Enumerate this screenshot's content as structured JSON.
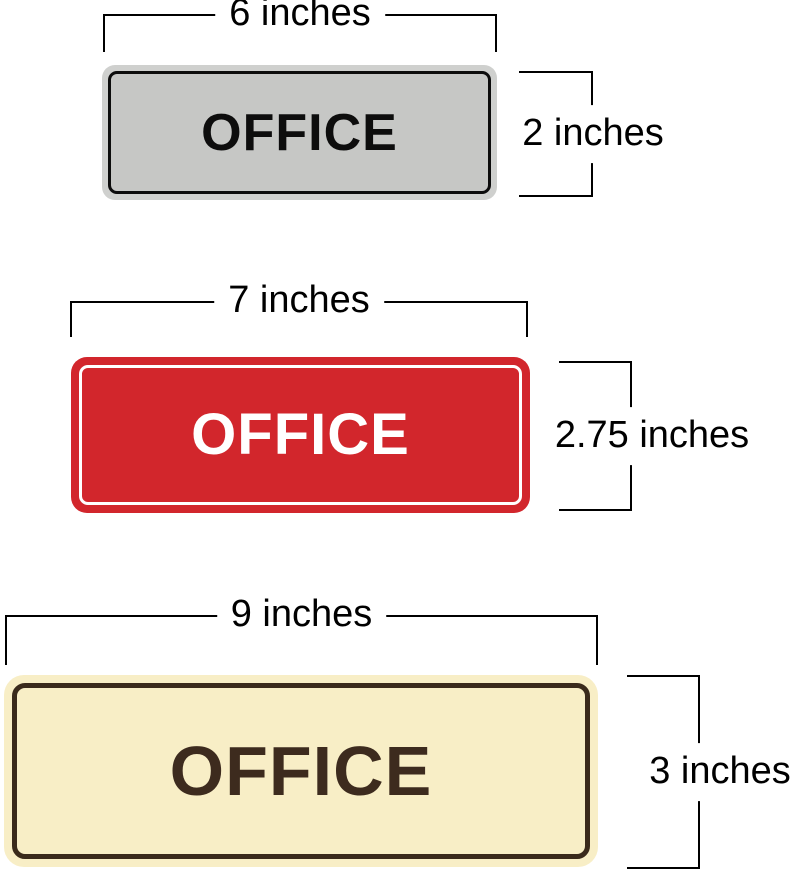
{
  "page": {
    "background": "#ffffff",
    "dimension_line_color": "#000000",
    "dimension_label_color": "#000000"
  },
  "signs": [
    {
      "label": "OFFICE",
      "width_label": "6 inches",
      "height_label": "2 inches",
      "fill": "#c6c7c5",
      "frame": "#cfd0ce",
      "border": "#0c0c0c",
      "text_color": "#0d0d0d"
    },
    {
      "label": "OFFICE",
      "width_label": "7 inches",
      "height_label": "2.75 inches",
      "fill": "#d2262c",
      "stroke": "#ffffff",
      "text_color": "#ffffff"
    },
    {
      "label": "OFFICE",
      "width_label": "9 inches",
      "height_label": "3 inches",
      "fill": "#f8eec6",
      "border": "#3a2a1b",
      "text_color": "#3d2b1e"
    }
  ]
}
